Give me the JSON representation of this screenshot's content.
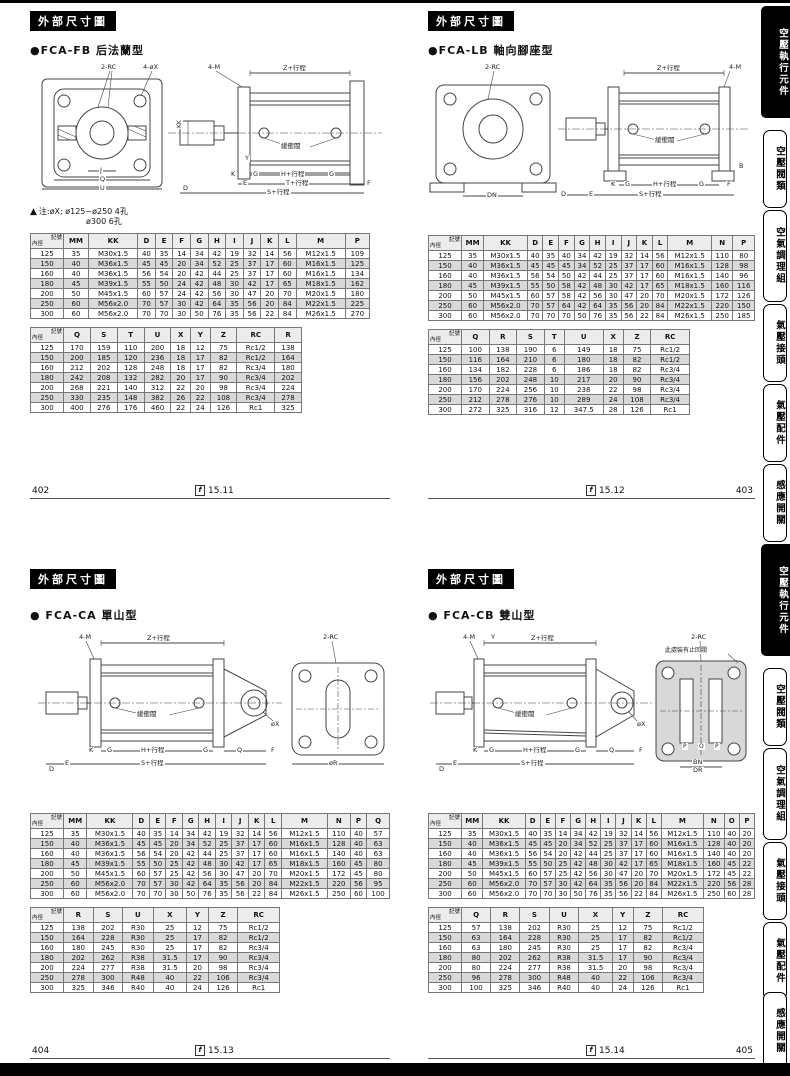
{
  "page": {
    "corner": {
      "top": "記號",
      "bottom": "內徑"
    },
    "ref_icon": "f",
    "footers": [
      {
        "page": "402",
        "ref": "15.11"
      },
      {
        "page": "403",
        "ref": "15.12"
      },
      {
        "page": "404",
        "ref": "15.13"
      },
      {
        "page": "405",
        "ref": "15.14"
      }
    ]
  },
  "sidebar": {
    "tabs": [
      {
        "label": "空壓執行元件"
      },
      {
        "label": "空壓閥類"
      },
      {
        "label": "空氣調理組"
      },
      {
        "label": "氣壓接頭"
      },
      {
        "label": "氣壓配件"
      },
      {
        "label": "感應開關"
      }
    ]
  },
  "quadrants": [
    {
      "id": "fb",
      "section_title": "外部尺寸圖",
      "model": "●FCA-FB 后法蘭型",
      "note_line1": "注:øX; ø125~ø250  4孔",
      "note_line2": "ø300        6孔",
      "labels": {
        "rc": "2-RC",
        "holes": "4-øX",
        "m": "4-M",
        "z": "Z+行程",
        "kk": "KK",
        "cushion": "緩衝閥",
        "h": "H+行程",
        "t": "T+行程",
        "s": "S+行程",
        "j": "J",
        "q": "Q",
        "u": "U",
        "d": "D",
        "e": "E",
        "k": "K",
        "g": "G",
        "f": "F",
        "y": "Y"
      },
      "table1": {
        "cols": [
          "MM",
          "KK",
          "D",
          "E",
          "F",
          "G",
          "H",
          "I",
          "J",
          "K",
          "L",
          "M",
          "P"
        ],
        "rows": [
          [
            125,
            35,
            "M30x1.5",
            40,
            35,
            14,
            34,
            42,
            19,
            32,
            14,
            56,
            "M12x1.5",
            109
          ],
          [
            150,
            40,
            "M36x1.5",
            45,
            45,
            20,
            34,
            52,
            25,
            37,
            17,
            60,
            "M16x1.5",
            125
          ],
          [
            160,
            40,
            "M36x1.5",
            56,
            54,
            20,
            42,
            44,
            25,
            37,
            17,
            60,
            "M16x1.5",
            134
          ],
          [
            180,
            45,
            "M39x1.5",
            55,
            50,
            24,
            42,
            48,
            30,
            42,
            17,
            65,
            "M18x1.5",
            162
          ],
          [
            200,
            50,
            "M45x1.5",
            60,
            57,
            24,
            42,
            56,
            30,
            47,
            20,
            70,
            "M20x1.5",
            180
          ],
          [
            250,
            60,
            "M56x2.0",
            70,
            57,
            30,
            42,
            64,
            35,
            56,
            20,
            84,
            "M22x1.5",
            225
          ],
          [
            300,
            60,
            "M56x2.0",
            70,
            70,
            30,
            50,
            76,
            35,
            56,
            22,
            84,
            "M26x1.5",
            270
          ]
        ]
      },
      "table2": {
        "cols": [
          "Q",
          "S",
          "T",
          "U",
          "X",
          "Y",
          "Z",
          "RC",
          "R"
        ],
        "rows": [
          [
            125,
            170,
            159,
            110,
            200,
            18,
            12,
            75,
            "Rc1/2",
            138
          ],
          [
            150,
            200,
            185,
            120,
            236,
            18,
            17,
            82,
            "Rc1/2",
            164
          ],
          [
            160,
            212,
            202,
            128,
            248,
            18,
            17,
            82,
            "Rc3/4",
            180
          ],
          [
            180,
            242,
            208,
            132,
            282,
            20,
            17,
            90,
            "Rc3/4",
            202
          ],
          [
            200,
            268,
            221,
            140,
            312,
            22,
            20,
            98,
            "Rc3/4",
            224
          ],
          [
            250,
            330,
            235,
            148,
            382,
            26,
            22,
            108,
            "Rc3/4",
            278
          ],
          [
            300,
            400,
            276,
            176,
            460,
            22,
            24,
            126,
            "Rc1",
            325
          ]
        ]
      }
    },
    {
      "id": "lb",
      "section_title": "外部尺寸圖",
      "model": "●FCA-LB 軸向腳座型",
      "labels": {
        "rc": "2-RC",
        "z": "Z+行程",
        "m": "4-M",
        "cushion": "緩衝閥",
        "h": "H+行程",
        "s": "S+行程",
        "dn": "DN",
        "e": "E",
        "g": "G",
        "f": "F",
        "k": "K",
        "b": "B",
        "d": "D"
      },
      "table1": {
        "cols": [
          "MM",
          "KK",
          "D",
          "E",
          "F",
          "G",
          "H",
          "I",
          "J",
          "K",
          "L",
          "M",
          "N",
          "P"
        ],
        "rows": [
          [
            125,
            35,
            "M30x1.5",
            40,
            35,
            40,
            34,
            42,
            19,
            32,
            14,
            56,
            "M12x1.5",
            110,
            80
          ],
          [
            150,
            40,
            "M36x1.5",
            45,
            45,
            45,
            34,
            52,
            25,
            37,
            17,
            60,
            "M16x1.5",
            128,
            98
          ],
          [
            160,
            40,
            "M36x1.5",
            56,
            54,
            50,
            42,
            44,
            25,
            37,
            17,
            60,
            "M16x1.5",
            140,
            96
          ],
          [
            180,
            45,
            "M39x1.5",
            55,
            50,
            58,
            42,
            48,
            30,
            42,
            17,
            65,
            "M18x1.5",
            160,
            116
          ],
          [
            200,
            50,
            "M45x1.5",
            60,
            57,
            58,
            42,
            56,
            30,
            47,
            20,
            70,
            "M20x1.5",
            172,
            126
          ],
          [
            250,
            60,
            "M56x2.0",
            70,
            57,
            64,
            42,
            64,
            35,
            56,
            20,
            84,
            "M22x1.5",
            220,
            150
          ],
          [
            300,
            60,
            "M56x2.0",
            70,
            70,
            70,
            50,
            76,
            35,
            56,
            22,
            84,
            "M26x1.5",
            250,
            185
          ]
        ]
      },
      "table2": {
        "cols": [
          "Q",
          "R",
          "S",
          "T",
          "U",
          "X",
          "Z",
          "RC"
        ],
        "rows": [
          [
            125,
            100,
            138,
            190,
            6,
            149,
            18,
            75,
            "Rc1/2"
          ],
          [
            150,
            116,
            164,
            210,
            6,
            180,
            18,
            82,
            "Rc1/2"
          ],
          [
            160,
            134,
            182,
            228,
            6,
            186,
            18,
            82,
            "Rc3/4"
          ],
          [
            180,
            156,
            202,
            248,
            10,
            217,
            20,
            90,
            "Rc3/4"
          ],
          [
            200,
            170,
            224,
            256,
            10,
            238,
            22,
            98,
            "Rc3/4"
          ],
          [
            250,
            212,
            278,
            276,
            10,
            289,
            24,
            108,
            "Rc3/4"
          ],
          [
            300,
            272,
            325,
            316,
            12,
            347.5,
            28,
            126,
            "Rc1"
          ]
        ]
      }
    },
    {
      "id": "ca",
      "section_title": "外部尺寸圖",
      "model": "● FCA-CA 單山型",
      "labels": {
        "m": "4-M",
        "z": "Z+行程",
        "rc": "2-RC",
        "cushion": "緩衝閥",
        "h": "H+行程",
        "s": "S+行程",
        "x": "øX",
        "q": "Q",
        "k": "K",
        "e": "E",
        "d": "D",
        "g": "G",
        "f": "F",
        "r": "øR"
      },
      "table1": {
        "cols": [
          "MM",
          "KK",
          "D",
          "E",
          "F",
          "G",
          "H",
          "I",
          "J",
          "K",
          "L",
          "M",
          "N",
          "P",
          "Q"
        ],
        "rows": [
          [
            125,
            35,
            "M30x1.5",
            40,
            35,
            14,
            34,
            42,
            19,
            32,
            14,
            56,
            "M12x1.5",
            110,
            40,
            57
          ],
          [
            150,
            40,
            "M36x1.5",
            45,
            45,
            20,
            34,
            52,
            25,
            37,
            17,
            60,
            "M16x1.5",
            128,
            40,
            63
          ],
          [
            160,
            40,
            "M36x1.5",
            56,
            54,
            20,
            42,
            44,
            25,
            37,
            17,
            60,
            "M16x1.5",
            140,
            40,
            63
          ],
          [
            180,
            45,
            "M39x1.5",
            55,
            50,
            25,
            42,
            48,
            30,
            42,
            17,
            65,
            "M18x1.5",
            160,
            45,
            80
          ],
          [
            200,
            50,
            "M45x1.5",
            60,
            57,
            25,
            42,
            56,
            30,
            47,
            20,
            70,
            "M20x1.5",
            172,
            45,
            80
          ],
          [
            250,
            60,
            "M56x2.0",
            70,
            57,
            30,
            42,
            64,
            35,
            56,
            20,
            84,
            "M22x1.5",
            220,
            56,
            95
          ],
          [
            300,
            60,
            "M56x2.0",
            70,
            70,
            30,
            50,
            76,
            35,
            56,
            22,
            84,
            "M26x1.5",
            250,
            60,
            100
          ]
        ]
      },
      "table2": {
        "cols": [
          "R",
          "S",
          "U",
          "X",
          "Y",
          "Z",
          "RC"
        ],
        "rows": [
          [
            125,
            138,
            202,
            "R30",
            25,
            12,
            75,
            "Rc1/2"
          ],
          [
            150,
            164,
            228,
            "R30",
            25,
            17,
            82,
            "Rc1/2"
          ],
          [
            160,
            180,
            245,
            "R30",
            25,
            17,
            82,
            "Rc3/4"
          ],
          [
            180,
            202,
            262,
            "R38",
            31.5,
            17,
            90,
            "Rc3/4"
          ],
          [
            200,
            224,
            277,
            "R38",
            31.5,
            20,
            98,
            "Rc3/4"
          ],
          [
            250,
            278,
            300,
            "R48",
            40,
            22,
            106,
            "Rc3/4"
          ],
          [
            300,
            325,
            346,
            "R40",
            40,
            24,
            126,
            "Rc1"
          ]
        ]
      }
    },
    {
      "id": "cb",
      "section_title": "外部尺寸圖",
      "model": "● FCA-CB 雙山型",
      "labels": {
        "m": "4-M",
        "y": "Y",
        "z": "Z+行程",
        "rc": "2-RC",
        "note": "此處裝有止回閥",
        "cushion": "緩衝閥",
        "x": "øX",
        "h": "H+行程",
        "s": "S+行程",
        "q": "Q",
        "k": "K",
        "e": "E",
        "d": "D",
        "g": "G",
        "f": "F",
        "p": "P",
        "o": "O",
        "bn": "BN",
        "dr": "DR"
      },
      "table1": {
        "cols": [
          "MM",
          "KK",
          "D",
          "E",
          "F",
          "G",
          "H",
          "I",
          "J",
          "K",
          "L",
          "M",
          "N",
          "O",
          "P"
        ],
        "rows": [
          [
            125,
            35,
            "M30x1.5",
            40,
            35,
            14,
            34,
            42,
            19,
            32,
            14,
            56,
            "M12x1.5",
            110,
            40,
            20
          ],
          [
            150,
            40,
            "M36x1.5",
            45,
            45,
            20,
            34,
            52,
            25,
            37,
            17,
            60,
            "M16x1.5",
            128,
            40,
            20
          ],
          [
            160,
            40,
            "M36x1.5",
            56,
            54,
            20,
            42,
            44,
            25,
            37,
            17,
            60,
            "M16x1.5",
            140,
            40,
            20
          ],
          [
            180,
            45,
            "M39x1.5",
            55,
            50,
            25,
            42,
            48,
            30,
            42,
            17,
            65,
            "M18x1.5",
            160,
            45,
            22
          ],
          [
            200,
            50,
            "M45x1.5",
            60,
            57,
            25,
            42,
            56,
            30,
            47,
            20,
            70,
            "M20x1.5",
            172,
            45,
            22
          ],
          [
            250,
            60,
            "M56x2.0",
            70,
            57,
            30,
            42,
            64,
            35,
            56,
            20,
            84,
            "M22x1.5",
            220,
            56,
            28
          ],
          [
            300,
            60,
            "M56x2.0",
            70,
            70,
            30,
            50,
            76,
            35,
            56,
            22,
            84,
            "M26x1.5",
            250,
            60,
            28
          ]
        ]
      },
      "table2": {
        "cols": [
          "Q",
          "R",
          "S",
          "U",
          "X",
          "Y",
          "Z",
          "RC"
        ],
        "rows": [
          [
            125,
            57,
            138,
            202,
            "R30",
            25,
            12,
            75,
            "Rc1/2"
          ],
          [
            150,
            63,
            164,
            228,
            "R30",
            25,
            17,
            82,
            "Rc1/2"
          ],
          [
            160,
            63,
            180,
            245,
            "R30",
            25,
            17,
            82,
            "Rc3/4"
          ],
          [
            180,
            80,
            202,
            262,
            "R38",
            31.5,
            17,
            90,
            "Rc3/4"
          ],
          [
            200,
            80,
            224,
            277,
            "R38",
            31.5,
            20,
            98,
            "Rc3/4"
          ],
          [
            250,
            96,
            278,
            300,
            "R48",
            40,
            22,
            106,
            "Rc3/4"
          ],
          [
            300,
            100,
            325,
            346,
            "R40",
            40,
            24,
            126,
            "Rc1"
          ]
        ]
      }
    }
  ]
}
